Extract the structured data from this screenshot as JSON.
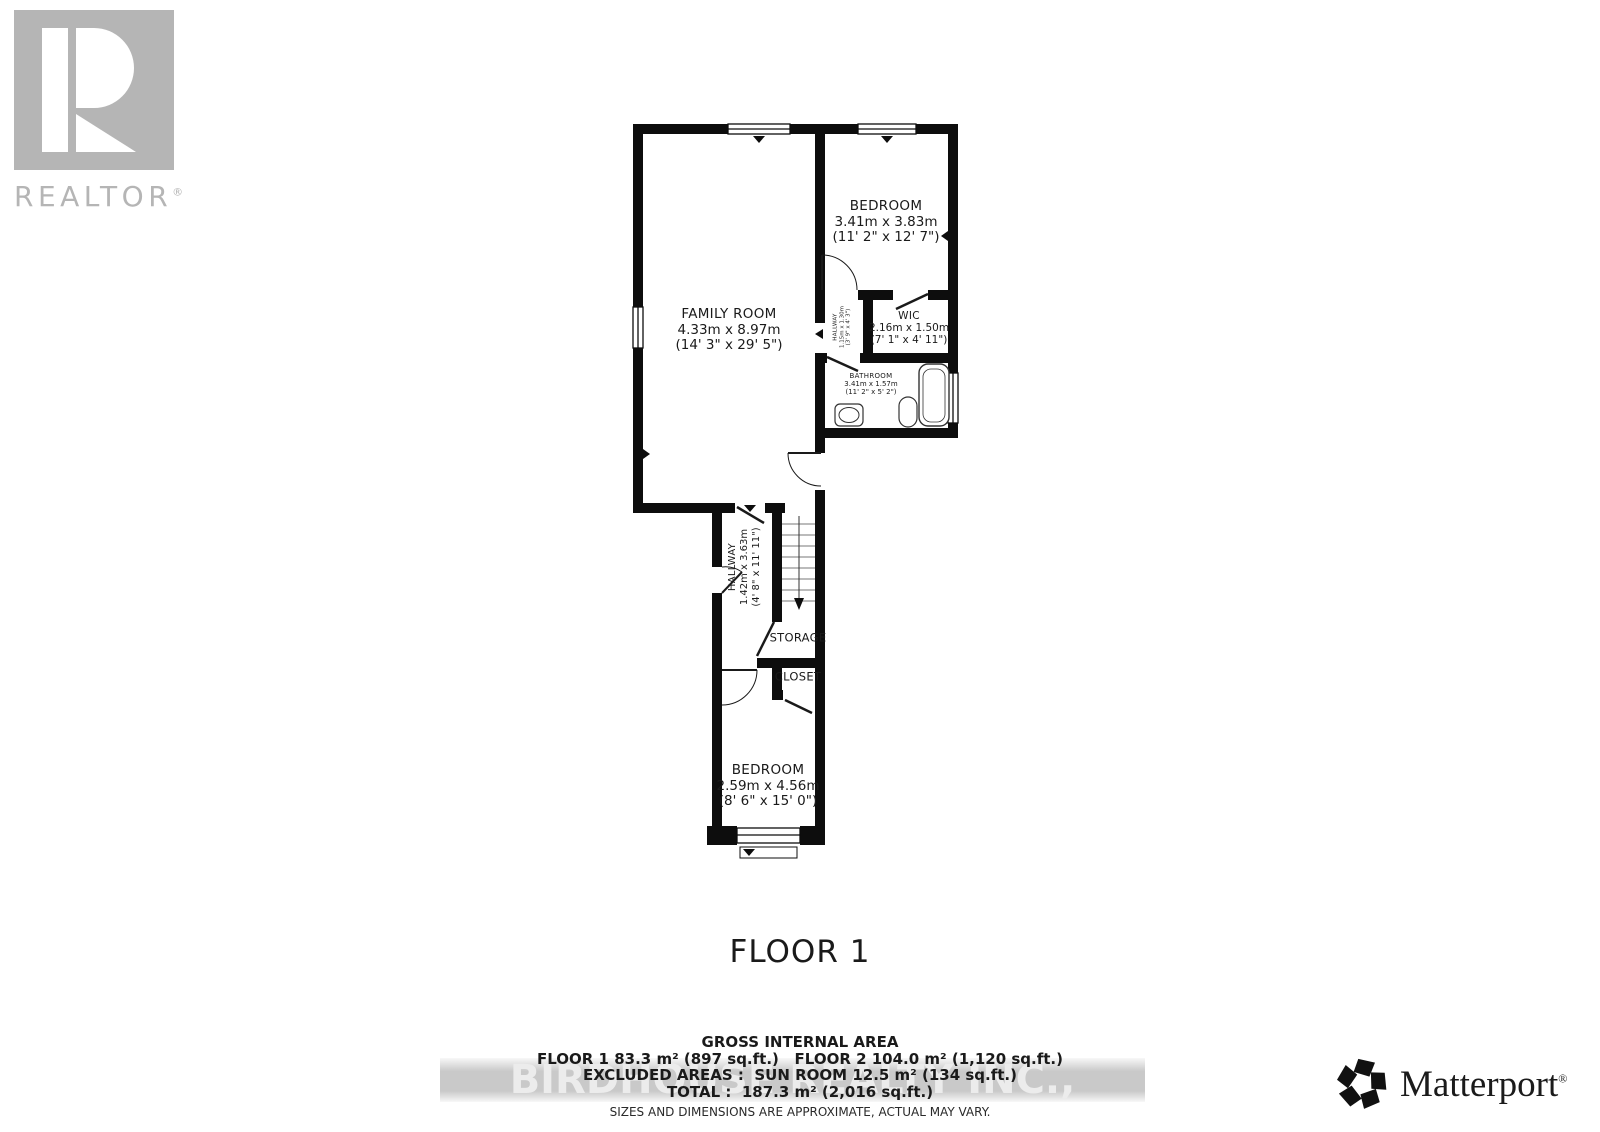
{
  "branding": {
    "realtor": {
      "label": "REALTOR",
      "reg": "®"
    },
    "matterport": {
      "label": "Matterport",
      "reg": "®"
    }
  },
  "watermark": "BIRDHOUSE REALTY INC., Brokerage",
  "title": "FLOOR 1",
  "area_summary": {
    "heading": "GROSS INTERNAL AREA",
    "floors_line": "FLOOR 1 83.3 m² (897 sq.ft.)   FLOOR 2 104.0 m² (1,120 sq.ft.)",
    "excluded_line": "EXCLUDED AREAS :  SUN ROOM 12.5 m² (134 sq.ft.)",
    "total_line": "TOTAL :  187.3 m² (2,016 sq.ft.)",
    "disclaimer": "SIZES AND DIMENSIONS ARE APPROXIMATE, ACTUAL MAY VARY."
  },
  "rooms": {
    "family_room": {
      "name": "FAMILY ROOM",
      "metric": "4.33m x 8.97m",
      "imperial": "(14' 3\" x 29' 5\")"
    },
    "bedroom_top": {
      "name": "BEDROOM",
      "metric": "3.41m x 3.83m",
      "imperial": "(11' 2\" x 12' 7\")"
    },
    "wic": {
      "name": "WIC",
      "metric": "2.16m x 1.50m",
      "imperial": "(7' 1\" x 4' 11\")"
    },
    "hallway_small": {
      "name": "HALLWAY",
      "metric": "1.15m x 1.30m",
      "imperial": "(3' 9\" x 4' 3\")"
    },
    "bathroom": {
      "name": "BATHROOM",
      "metric": "3.41m x 1.57m",
      "imperial": "(11' 2\" x 5' 2\")"
    },
    "hallway_main": {
      "name": "HALLWAY",
      "metric": "1.42m x 3.63m",
      "imperial": "(4' 8\" x 11' 11\")"
    },
    "storage": {
      "name": "STORAGE"
    },
    "closet": {
      "name": "CLOSET"
    },
    "bedroom_bottom": {
      "name": "BEDROOM",
      "metric": "2.59m x 4.56m",
      "imperial": "(8' 6\" x 15' 0\")"
    }
  }
}
